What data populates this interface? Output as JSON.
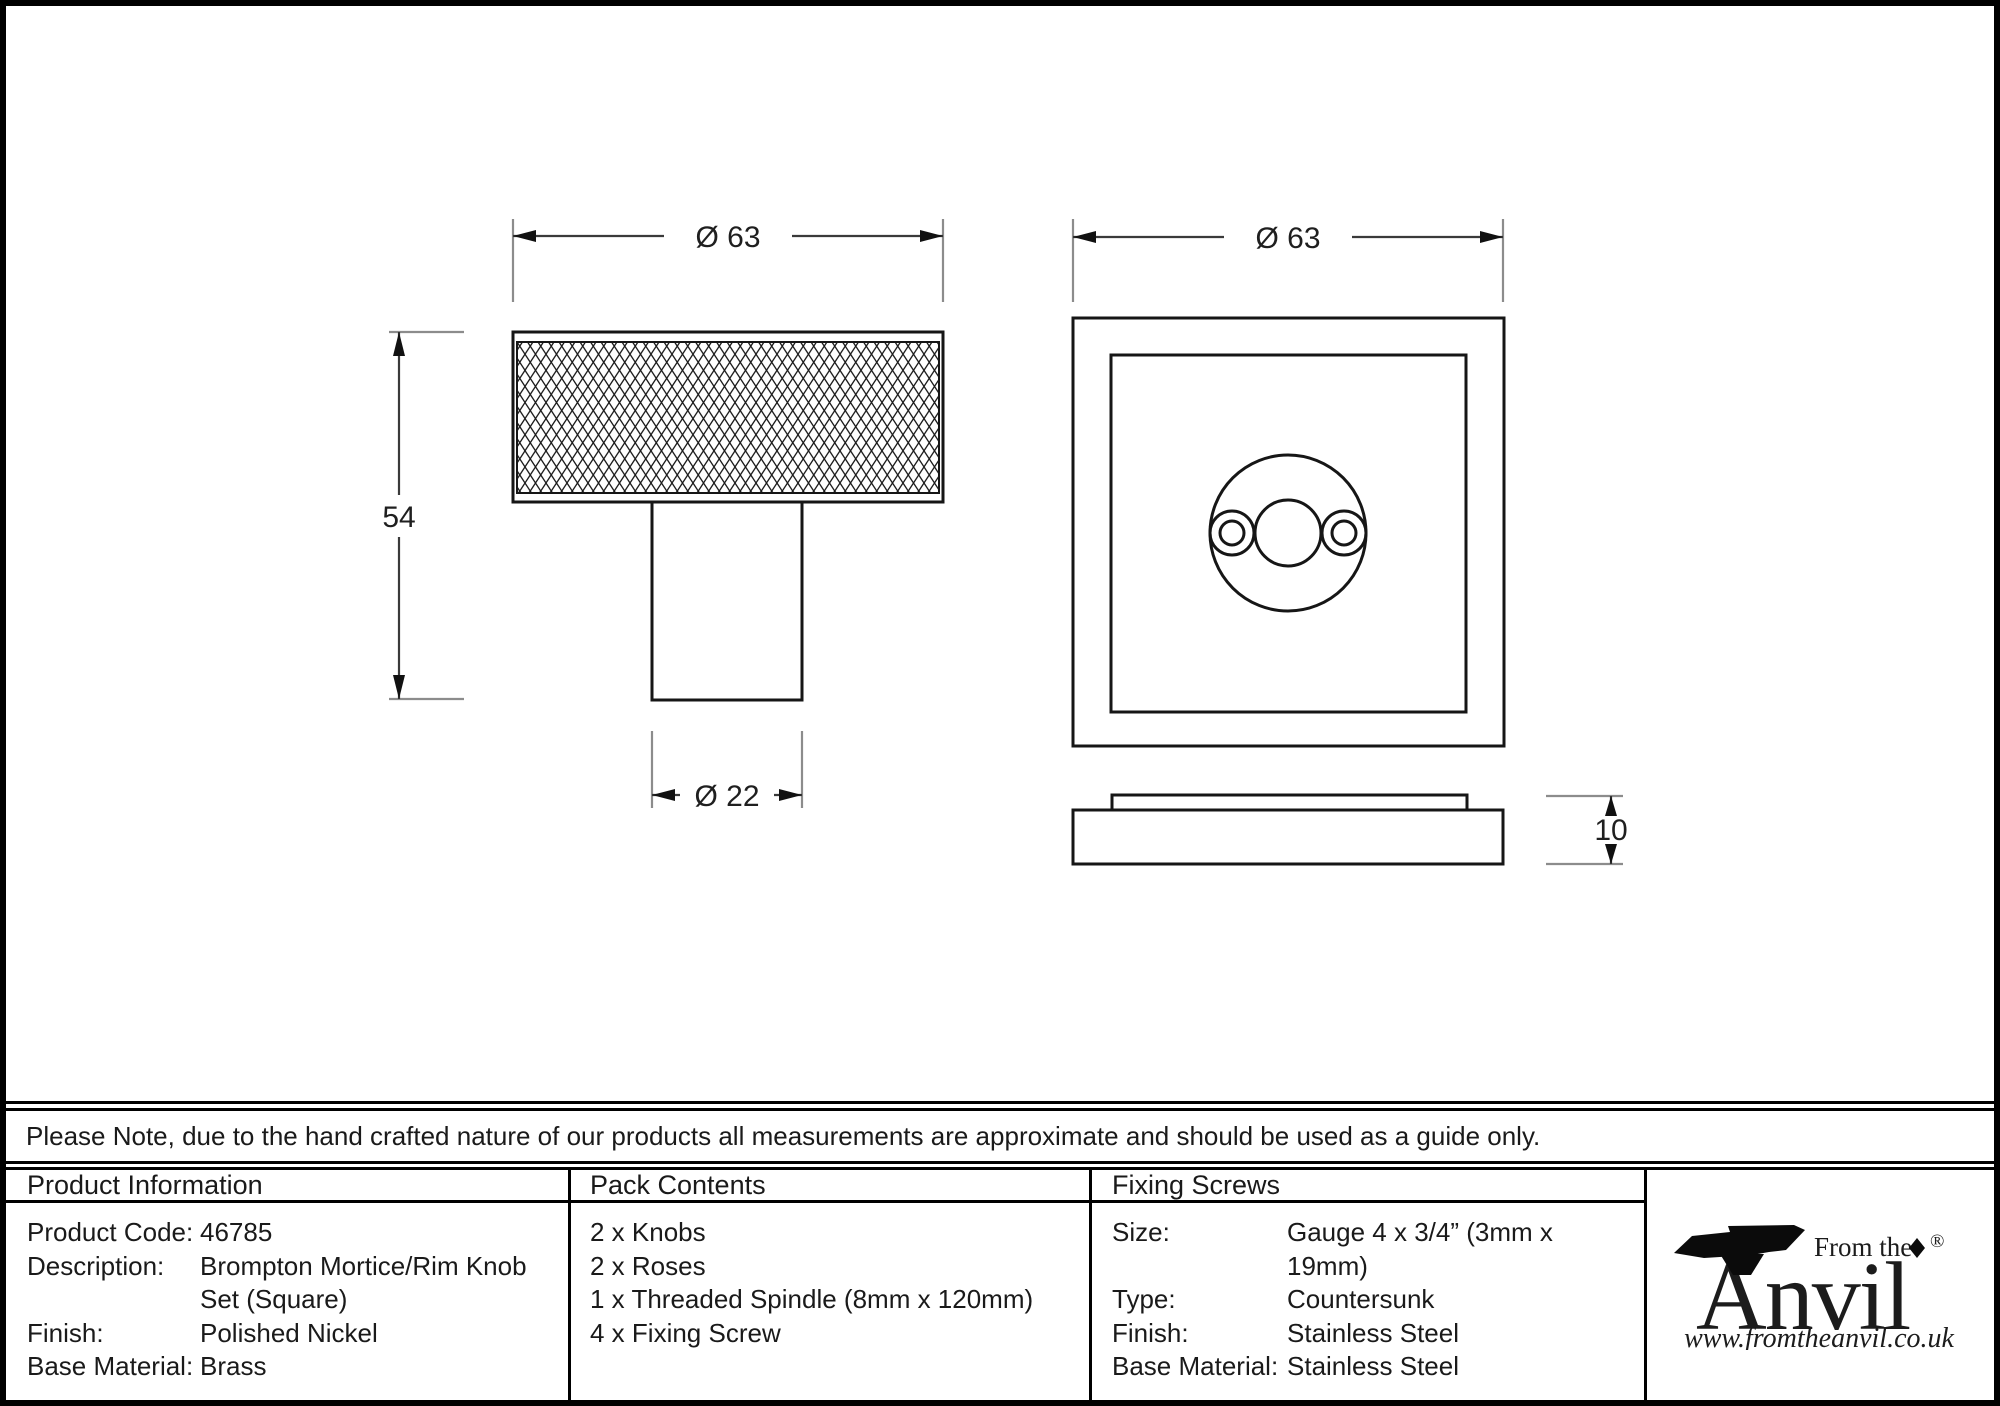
{
  "drawing": {
    "knob": {
      "diameter_label": "Ø 63",
      "height_label": "54",
      "stem_diameter_label": "Ø 22"
    },
    "rose": {
      "diameter_label": "Ø 63",
      "thickness_label": "10"
    }
  },
  "note": "Please Note, due to the hand crafted nature of our products all measurements are approximate and should be used as a guide only.",
  "product_information": {
    "title": "Product Information",
    "rows": [
      {
        "label": "Product Code:",
        "value": "46785"
      },
      {
        "label": "Description:",
        "value": "Brompton Mortice/Rim Knob Set (Square)"
      },
      {
        "label": "Finish:",
        "value": "Polished Nickel"
      },
      {
        "label": "Base Material:",
        "value": "Brass"
      }
    ]
  },
  "pack_contents": {
    "title": "Pack Contents",
    "items": [
      "2 x Knobs",
      "2 x Roses",
      "1 x Threaded Spindle (8mm x 120mm)",
      "4 x Fixing Screw"
    ]
  },
  "fixing_screws": {
    "title": "Fixing Screws",
    "rows": [
      {
        "label": "Size:",
        "value": "Gauge 4 x 3/4” (3mm x 19mm)"
      },
      {
        "label": "Type:",
        "value": "Countersunk"
      },
      {
        "label": "Finish:",
        "value": "Stainless Steel"
      },
      {
        "label": "Base Material:",
        "value": "Stainless Steel"
      }
    ]
  },
  "logo": {
    "tagline": "From the",
    "name": "Anvil",
    "registered": "®",
    "website": "www.fromtheanvil.co.uk"
  }
}
